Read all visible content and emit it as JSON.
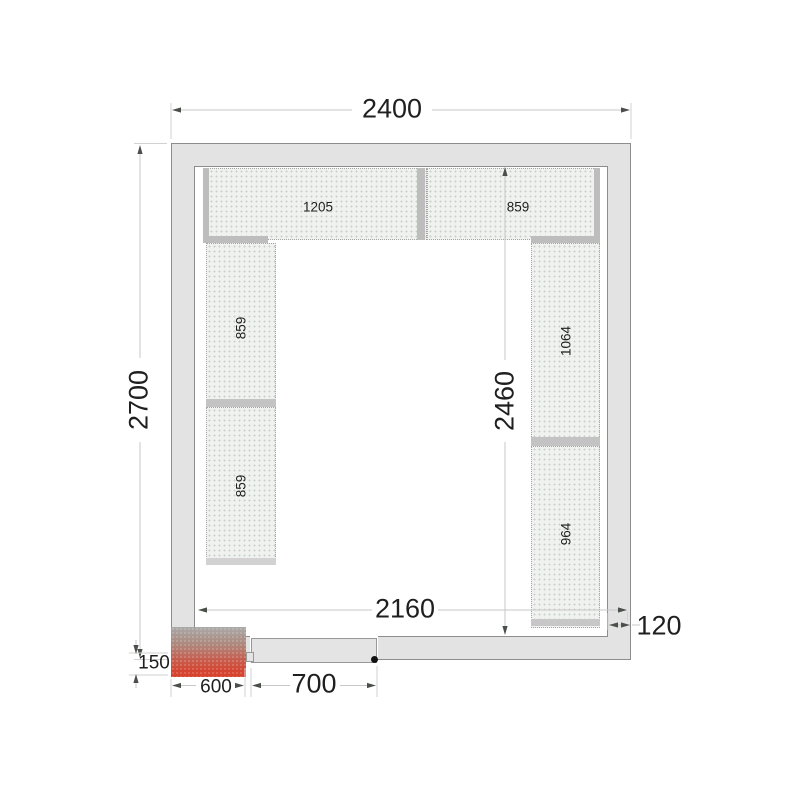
{
  "drawing": {
    "type": "cold-room-floor-plan",
    "dimensions": {
      "outer_width": "2400",
      "outer_height": "2700",
      "inner_width": "2160",
      "inner_height": "2460",
      "wall_thickness": "120",
      "unit_protrusion": "150",
      "unit_width": "600",
      "door_width": "700"
    },
    "shelves": {
      "top_left": "1205",
      "top_right": "859",
      "left_upper": "859",
      "left_lower": "859",
      "right_upper": "1064",
      "right_lower": "964"
    },
    "colors": {
      "wall_fill": "#e3e3e3",
      "wall_outline": "#8d8d8d",
      "shelf_fill": "#f0f2ef",
      "support_bar": "#bdbdbd",
      "unit_red": "#d23a26",
      "dim_line": "#c7c7c7",
      "arrow": "#4a4f4a",
      "text": "#1f1f1f"
    }
  }
}
